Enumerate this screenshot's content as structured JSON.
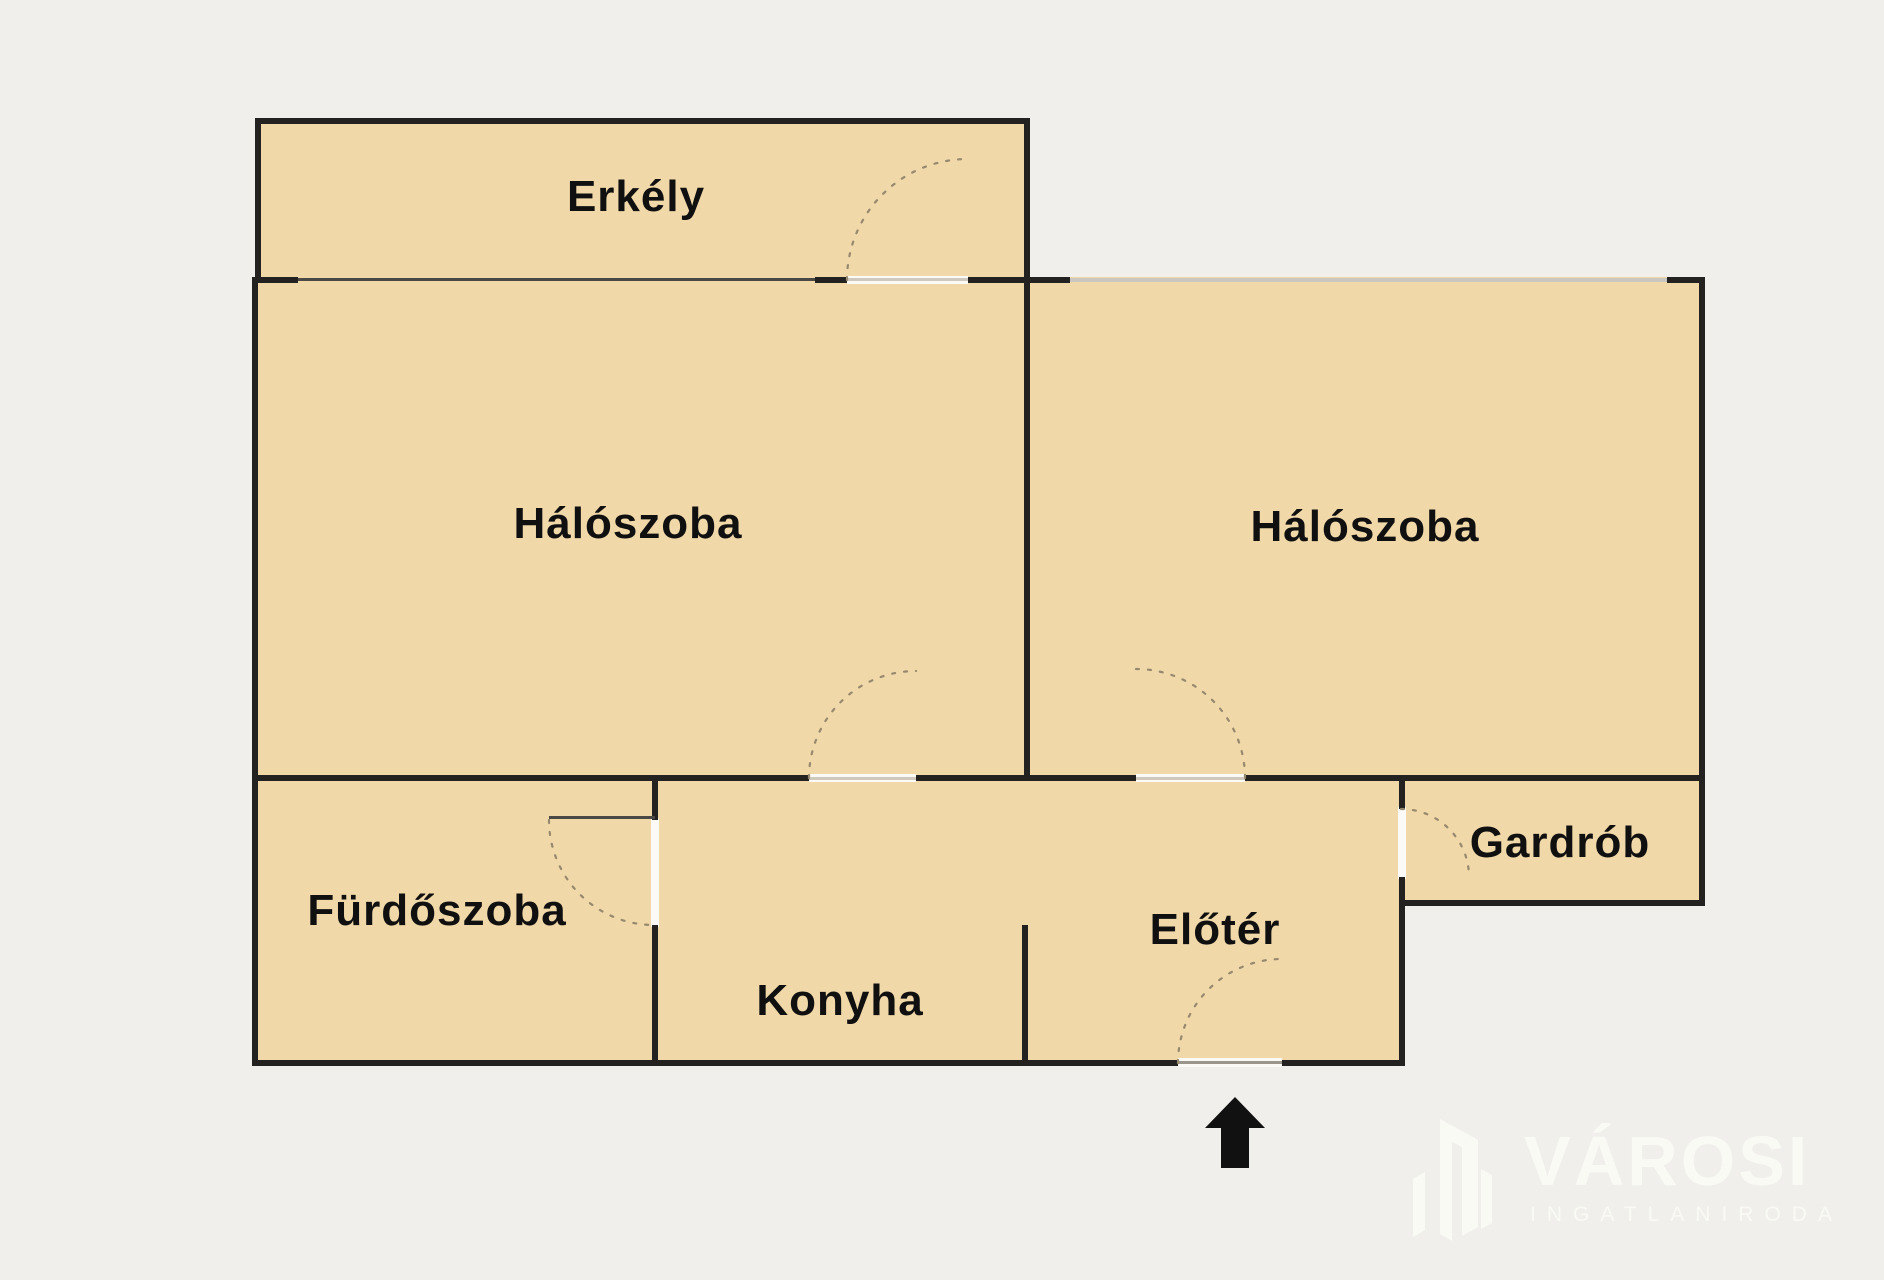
{
  "colors": {
    "background": "#f0efeb",
    "room_fill": "#f0d8a8",
    "wall": "#232220",
    "window_dark": "#4a4945",
    "window_light": "#c9c7c0",
    "opening": "#fbfaf6",
    "opening_line": "#cfc9bd",
    "entry_line": "#9b968c",
    "swing_arc": "#97896f",
    "label": "#101010",
    "logo": "#fafaf5",
    "arrow": "#111111"
  },
  "floorplan": {
    "rooms": [
      {
        "key": "balcony",
        "label": "Erkély"
      },
      {
        "key": "bedroom-left",
        "label": "Hálószoba"
      },
      {
        "key": "bedroom-right",
        "label": "Hálószoba"
      },
      {
        "key": "bathroom",
        "label": "Fürdőszoba"
      },
      {
        "key": "kitchen",
        "label": "Konyha"
      },
      {
        "key": "foyer",
        "label": "Előtér"
      },
      {
        "key": "wardrobe",
        "label": "Gardrób"
      }
    ],
    "entrance": {
      "symbol": "arrow-up"
    }
  },
  "watermark": {
    "brand": "VÁROSI",
    "subtitle": "INGATLANIRODA"
  }
}
